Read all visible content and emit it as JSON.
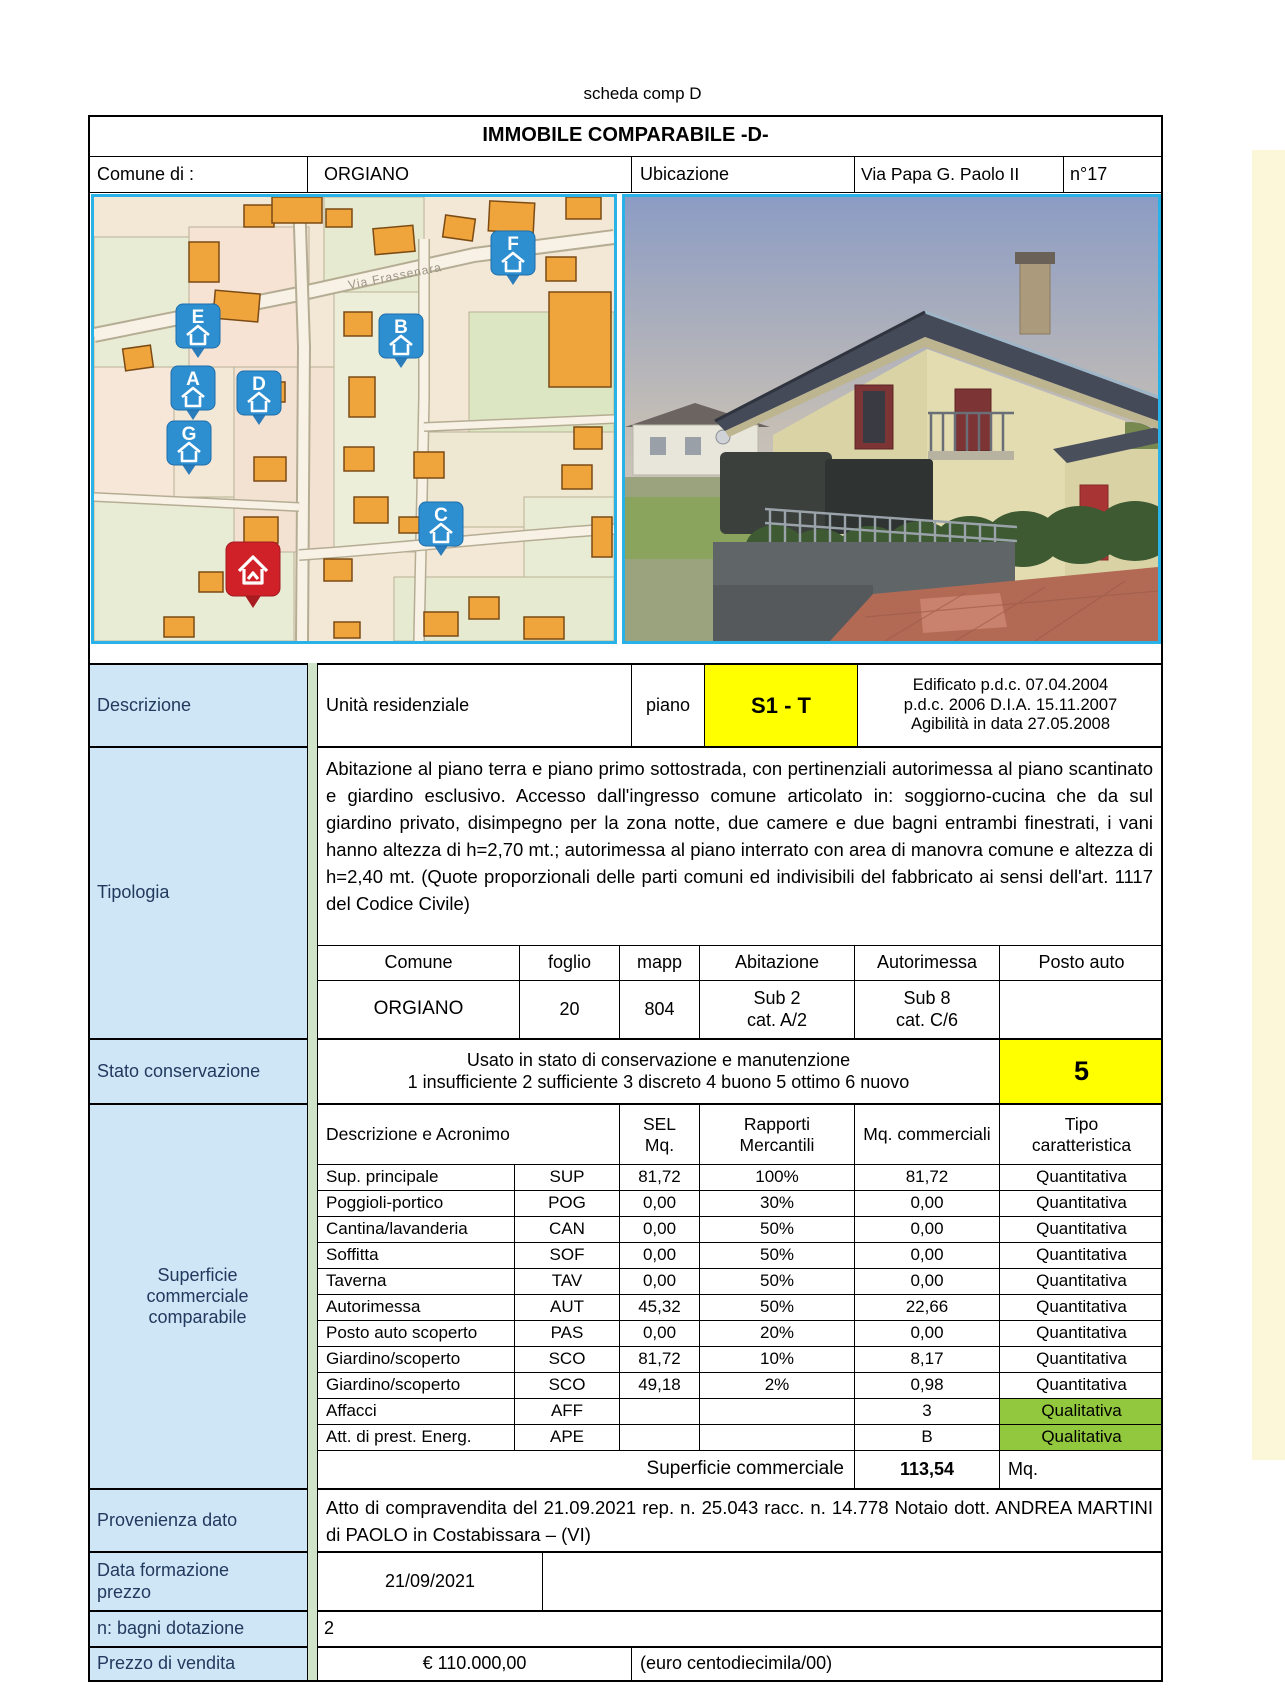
{
  "page_title": "scheda comp D",
  "header": {
    "title": "IMMOBILE COMPARABILE -D-"
  },
  "location": {
    "comune_label": "Comune di :",
    "comune_value": "ORGIANO",
    "ubicazione_label": "Ubicazione",
    "street": "Via Papa G. Paolo II",
    "number": "n°17"
  },
  "map": {
    "street_label": "Via Frassenara",
    "markers": [
      {
        "letter": "A"
      },
      {
        "letter": "B"
      },
      {
        "letter": "C"
      },
      {
        "letter": "D"
      },
      {
        "letter": "E"
      },
      {
        "letter": "F"
      },
      {
        "letter": "G"
      }
    ]
  },
  "descrizione": {
    "label": "Descrizione",
    "value": "Unità residenziale",
    "piano_label": "piano",
    "piano_value": "S1 - T",
    "edificato_lines": [
      "Edificato p.d.c. 07.04.2004",
      "p.d.c.  2006 D.I.A. 15.11.2007",
      "Agibilità in data 27.05.2008"
    ]
  },
  "tipologia": {
    "label": "Tipologia",
    "text": "Abitazione al piano terra e piano primo sottostrada, con pertinenziali autorimessa al piano scantinato e giardino esclusivo. Accesso dall'ingresso comune articolato in: soggiorno-cucina che da sul giardino privato, disimpegno per la zona notte, due camere e due bagni entrambi finestrati, i vani hanno altezza di h=2,70 mt.;  autorimessa al piano interrato con area di manovra comune e altezza di h=2,40 mt. (Quote proporzionali delle parti comuni ed indivisibili del fabbricato ai sensi dell'art. 1117 del Codice Civile)"
  },
  "catasto": {
    "headers": [
      "Comune",
      "foglio",
      "mapp",
      "Abitazione",
      "Autorimessa",
      "Posto auto"
    ],
    "comune": "ORGIANO",
    "foglio": "20",
    "mapp": "804",
    "abitazione": "Sub  2\ncat. A/2",
    "autorimessa": "Sub  8\ncat. C/6",
    "posto_auto": ""
  },
  "stato": {
    "label": "Stato conservazione",
    "line1": "Usato in  stato di conservazione e manutenzione",
    "line2": "1 insufficiente   2 sufficiente   3 discreto   4 buono   5 ottimo  6 nuovo",
    "value": "5"
  },
  "superficie": {
    "label": "Superficie commerciale comparabile",
    "header": {
      "desc_acr": "Descrizione e Acronimo",
      "sel": "SEL\nMq.",
      "rapporti": "Rapporti\nMercantili",
      "mq": "Mq. commerciali",
      "tipo": "Tipo\ncaratteristica"
    },
    "rows": [
      {
        "name": "Sup. principale",
        "acr": "SUP",
        "sel": "81,72",
        "rap": "100%",
        "mq": "81,72",
        "tipo": "Quantitativa"
      },
      {
        "name": "Poggioli-portico",
        "acr": "POG",
        "sel": "0,00",
        "rap": "30%",
        "mq": "0,00",
        "tipo": "Quantitativa"
      },
      {
        "name": "Cantina/lavanderia",
        "acr": "CAN",
        "sel": "0,00",
        "rap": "50%",
        "mq": "0,00",
        "tipo": "Quantitativa"
      },
      {
        "name": "Soffitta",
        "acr": "SOF",
        "sel": "0,00",
        "rap": "50%",
        "mq": "0,00",
        "tipo": "Quantitativa"
      },
      {
        "name": "Taverna",
        "acr": "TAV",
        "sel": "0,00",
        "rap": "50%",
        "mq": "0,00",
        "tipo": "Quantitativa"
      },
      {
        "name": "Autorimessa",
        "acr": "AUT",
        "sel": "45,32",
        "rap": "50%",
        "mq": "22,66",
        "tipo": "Quantitativa"
      },
      {
        "name": "Posto auto scoperto",
        "acr": "PAS",
        "sel": "0,00",
        "rap": "20%",
        "mq": "0,00",
        "tipo": "Quantitativa"
      },
      {
        "name": "Giardino/scoperto",
        "acr": "SCO",
        "sel": "81,72",
        "rap": "10%",
        "mq": "8,17",
        "tipo": "Quantitativa"
      },
      {
        "name": "Giardino/scoperto",
        "acr": "SCO",
        "sel": "49,18",
        "rap": "2%",
        "mq": "0,98",
        "tipo": "Quantitativa"
      },
      {
        "name": "Affacci",
        "acr": "AFF",
        "sel": "",
        "rap": "",
        "mq": "3",
        "tipo": "Qualitativa"
      },
      {
        "name": "Att. di prest. Energ.",
        "acr": "APE",
        "sel": "",
        "rap": "",
        "mq": "B",
        "tipo": "Qualitativa"
      }
    ],
    "totale_label": "Superficie commerciale",
    "totale_value": "113,54",
    "totale_unit": "Mq."
  },
  "provenienza": {
    "label": "Provenienza dato",
    "text": "Atto di compravendita del  21.09.2021   rep. n.  25.043  racc. n.  14.778    Notaio dott. ANDREA  MARTINI  di  PAOLO   in  Costabissara  –  (VI)"
  },
  "data_formazione": {
    "label": "Data formazione prezzo",
    "value": "21/09/2021"
  },
  "bagni": {
    "label": "n: bagni dotazione",
    "value": "2"
  },
  "prezzo": {
    "label": "Prezzo di vendita",
    "value": "€ 110.000,00",
    "text": "(euro centodiecimila/00)"
  },
  "colors": {
    "highlight_yellow": "#ffff00",
    "qualitative_green": "#92c83e",
    "label_blue": "#cfe6f7",
    "image_border_cyan": "#29b2e8",
    "marker_blue": "#2e8fd0",
    "subject_marker_red": "#cf2127"
  }
}
